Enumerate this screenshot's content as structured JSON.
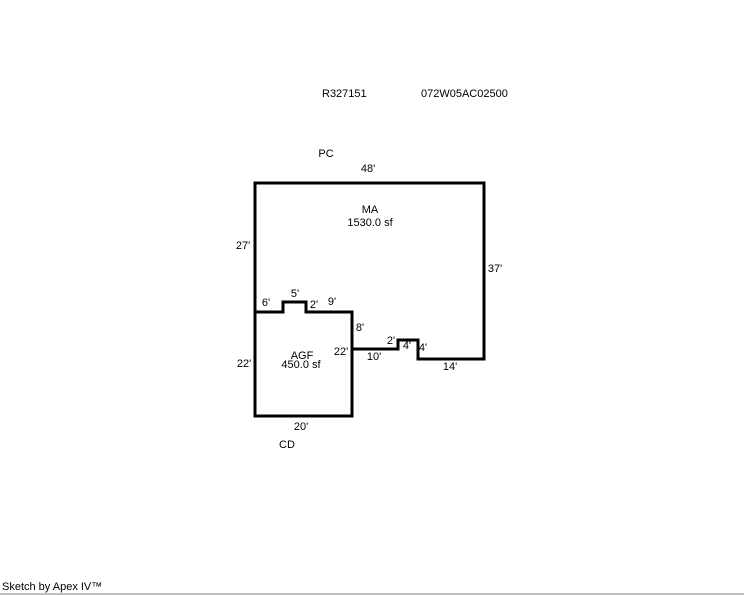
{
  "page": {
    "background_color": "#ffffff",
    "line_color": "#000000",
    "text_color": "#000000",
    "bottom_bar_color": "#bfbfbf"
  },
  "header": {
    "record_id": "R327151",
    "parcel_id": "072W05AC02500"
  },
  "footer": {
    "credit": "Sketch by Apex IV™"
  },
  "sketch": {
    "scale_px_per_ft": 4.78,
    "outlines": [
      {
        "name": "main-area-outline",
        "closed": true,
        "points": [
          [
            255,
            183
          ],
          [
            484,
            183
          ],
          [
            484,
            359
          ],
          [
            418,
            359
          ],
          [
            418,
            340
          ],
          [
            398,
            340
          ],
          [
            398,
            349
          ],
          [
            352,
            349
          ],
          [
            352,
            312
          ],
          [
            306,
            312
          ],
          [
            306,
            302
          ],
          [
            283,
            302
          ],
          [
            283,
            312
          ],
          [
            255,
            312
          ]
        ]
      },
      {
        "name": "garage-outline",
        "closed": false,
        "points": [
          [
            255,
            312
          ],
          [
            255,
            416
          ],
          [
            352,
            416
          ],
          [
            352,
            349
          ]
        ]
      }
    ],
    "labels": [
      {
        "name": "area-label-pc",
        "text": "PC",
        "x": 326,
        "y": 154
      },
      {
        "name": "dim-top-48",
        "text": "48'",
        "x": 368,
        "y": 169
      },
      {
        "name": "area-label-ma",
        "text": "MA",
        "x": 370,
        "y": 210
      },
      {
        "name": "area-size-ma",
        "text": "1530.0 sf",
        "x": 370,
        "y": 223
      },
      {
        "name": "dim-left-27",
        "text": "27'",
        "x": 243,
        "y": 246
      },
      {
        "name": "dim-right-37",
        "text": "37'",
        "x": 495,
        "y": 269
      },
      {
        "name": "dim-6",
        "text": "6'",
        "x": 266,
        "y": 303
      },
      {
        "name": "dim-5",
        "text": "5'",
        "x": 295,
        "y": 294
      },
      {
        "name": "dim-2-notch",
        "text": "2'",
        "x": 314,
        "y": 305
      },
      {
        "name": "dim-9",
        "text": "9'",
        "x": 332,
        "y": 302
      },
      {
        "name": "dim-8",
        "text": "8'",
        "x": 360,
        "y": 328
      },
      {
        "name": "dim-22-right",
        "text": "22'",
        "x": 341,
        "y": 352
      },
      {
        "name": "dim-10",
        "text": "10'",
        "x": 374,
        "y": 357
      },
      {
        "name": "dim-2-step",
        "text": "2'",
        "x": 391,
        "y": 341
      },
      {
        "name": "dim-4-top",
        "text": "4'",
        "x": 407,
        "y": 346
      },
      {
        "name": "dim-4-side",
        "text": "4'",
        "x": 423,
        "y": 348
      },
      {
        "name": "dim-14",
        "text": "14'",
        "x": 450,
        "y": 367
      },
      {
        "name": "dim-22-left",
        "text": "22'",
        "x": 244,
        "y": 364
      },
      {
        "name": "area-label-agf",
        "text": "AGF",
        "x": 302,
        "y": 356
      },
      {
        "name": "area-size-agf",
        "text": "450.0 sf",
        "x": 301,
        "y": 365
      },
      {
        "name": "dim-20",
        "text": "20'",
        "x": 301,
        "y": 427
      },
      {
        "name": "area-label-cd",
        "text": "CD",
        "x": 287,
        "y": 445
      }
    ]
  }
}
